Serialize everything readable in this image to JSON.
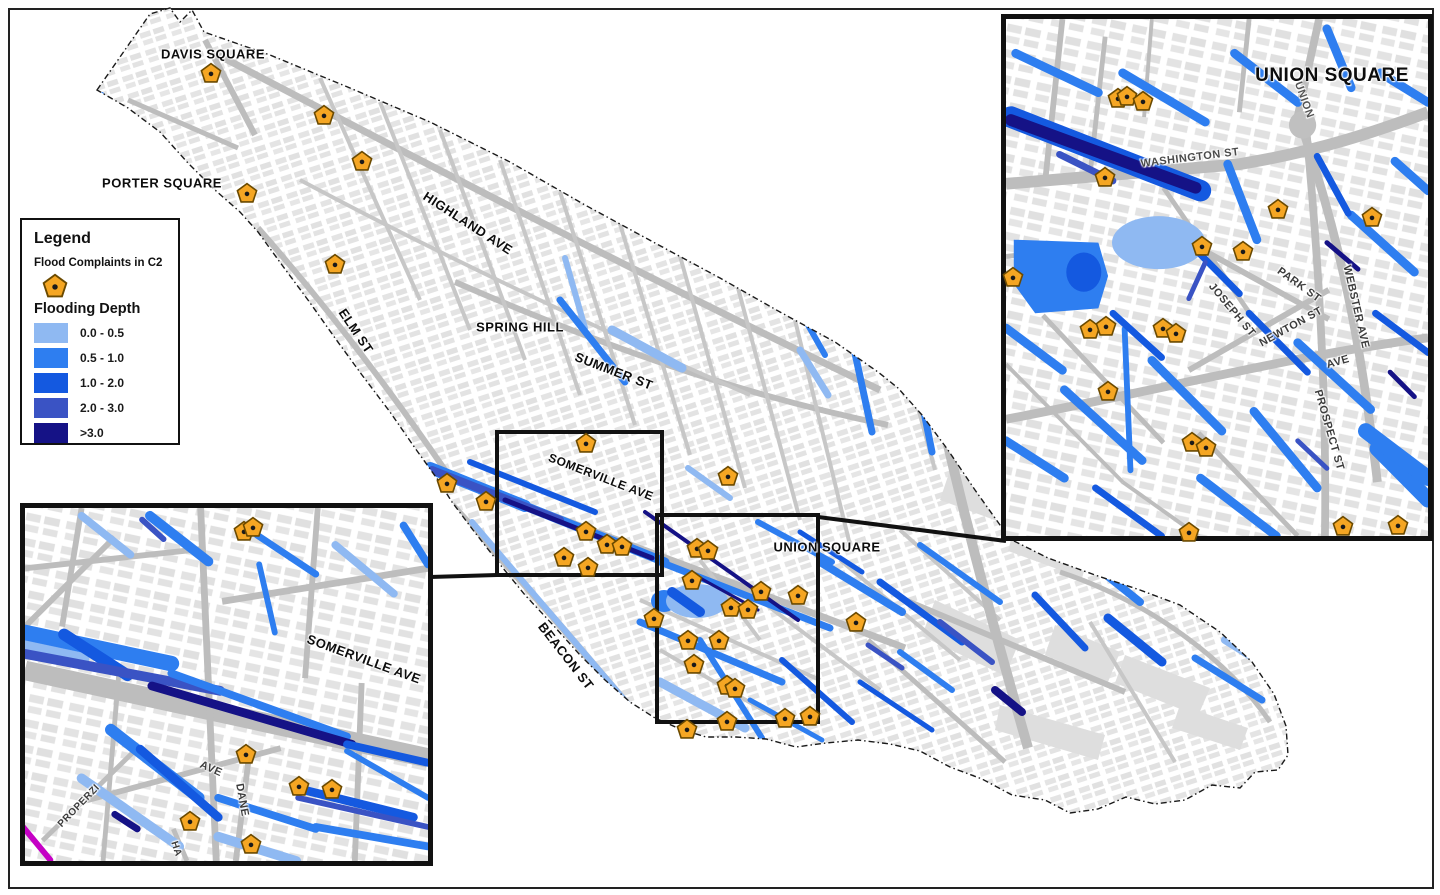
{
  "legend": {
    "title": "Legend",
    "complaints_label": "Flood Complaints in C2",
    "depth_title": "Flooding Depth",
    "marker_color": "#F5A623",
    "marker_outline": "#6B4A00",
    "classes": [
      {
        "label": "0.0 - 0.5",
        "color": "#8FB9F2"
      },
      {
        "label": "0.5 - 1.0",
        "color": "#2E7EF0"
      },
      {
        "label": "1.0 - 2.0",
        "color": "#1459E0"
      },
      {
        "label": "2.0 - 3.0",
        "color": "#3A53C4"
      },
      {
        "label": ">3.0",
        "color": "#151286"
      }
    ]
  },
  "main_map": {
    "labels": [
      {
        "text": "DAVIS SQUARE",
        "x": 213,
        "y": 54,
        "rot": 0,
        "size": 13
      },
      {
        "text": "PORTER SQUARE",
        "x": 162,
        "y": 183,
        "rot": 0,
        "size": 13
      },
      {
        "text": "HIGHLAND AVE",
        "x": 468,
        "y": 223,
        "rot": 33,
        "size": 13
      },
      {
        "text": "ELM ST",
        "x": 356,
        "y": 331,
        "rot": 56,
        "size": 13
      },
      {
        "text": "SPRING HILL",
        "x": 520,
        "y": 327,
        "rot": 0,
        "size": 13
      },
      {
        "text": "SUMMER ST",
        "x": 614,
        "y": 371,
        "rot": 21,
        "size": 13
      },
      {
        "text": "SOMERVILLE AVE",
        "x": 601,
        "y": 477,
        "rot": 21,
        "size": 12
      },
      {
        "text": "UNION SQUARE",
        "x": 827,
        "y": 547,
        "rot": 0,
        "size": 13
      },
      {
        "text": "BEACON ST",
        "x": 566,
        "y": 656,
        "rot": 52,
        "size": 13
      }
    ],
    "markers": [
      [
        211,
        74
      ],
      [
        324,
        116
      ],
      [
        362,
        162
      ],
      [
        247,
        194
      ],
      [
        335,
        265
      ],
      [
        447,
        484
      ],
      [
        486,
        502
      ],
      [
        586,
        444
      ],
      [
        728,
        477
      ],
      [
        586,
        532
      ],
      [
        607,
        545
      ],
      [
        622,
        547
      ],
      [
        564,
        558
      ],
      [
        588,
        568
      ],
      [
        697,
        549
      ],
      [
        708,
        551
      ],
      [
        692,
        581
      ],
      [
        761,
        592
      ],
      [
        798,
        596
      ],
      [
        731,
        608
      ],
      [
        748,
        610
      ],
      [
        654,
        619
      ],
      [
        688,
        641
      ],
      [
        719,
        641
      ],
      [
        694,
        665
      ],
      [
        727,
        686
      ],
      [
        735,
        689
      ],
      [
        856,
        623
      ],
      [
        687,
        730
      ],
      [
        727,
        722
      ],
      [
        785,
        719
      ],
      [
        810,
        717
      ]
    ]
  },
  "inset_top_right": {
    "labels": [
      {
        "text": "UNION SQUARE",
        "x": 1332,
        "y": 76,
        "rot": 0,
        "size": 19
      },
      {
        "text": "WASHINGTON ST",
        "x": 1190,
        "y": 158,
        "rot": -7,
        "size": 11,
        "color": "#4A4A4A"
      },
      {
        "text": "UNION",
        "x": 1304,
        "y": 100,
        "rot": 70,
        "size": 11,
        "color": "#555555"
      },
      {
        "text": "PARK ST",
        "x": 1299,
        "y": 285,
        "rot": 36,
        "size": 11,
        "color": "#3C3C3C"
      },
      {
        "text": "JOSEPH ST",
        "x": 1232,
        "y": 310,
        "rot": 50,
        "size": 11,
        "color": "#3C3C3C"
      },
      {
        "text": "NEWTON ST",
        "x": 1291,
        "y": 327,
        "rot": -29,
        "size": 11,
        "color": "#3C3C3C"
      },
      {
        "text": "WEBSTER AVE",
        "x": 1356,
        "y": 307,
        "rot": 77,
        "size": 11,
        "color": "#3C3C3C"
      },
      {
        "text": "AVE",
        "x": 1338,
        "y": 362,
        "rot": -16,
        "size": 11,
        "color": "#3C3C3C"
      },
      {
        "text": "PROSPECT ST",
        "x": 1329,
        "y": 430,
        "rot": 74,
        "size": 11,
        "color": "#3C3C3C"
      }
    ],
    "markers": [
      [
        1118,
        99
      ],
      [
        1127,
        97
      ],
      [
        1143,
        102
      ],
      [
        1105,
        178
      ],
      [
        1278,
        210
      ],
      [
        1372,
        218
      ],
      [
        1202,
        247
      ],
      [
        1243,
        252
      ],
      [
        1013,
        278
      ],
      [
        1090,
        330
      ],
      [
        1106,
        327
      ],
      [
        1163,
        329
      ],
      [
        1176,
        334
      ],
      [
        1108,
        392
      ],
      [
        1192,
        443
      ],
      [
        1206,
        448
      ],
      [
        1189,
        533
      ],
      [
        1343,
        527
      ],
      [
        1398,
        526
      ]
    ]
  },
  "inset_bottom_left": {
    "labels": [
      {
        "text": "SOMERVILLE AVE",
        "x": 364,
        "y": 659,
        "rot": 20,
        "size": 13
      },
      {
        "text": "AVE",
        "x": 211,
        "y": 769,
        "rot": 24,
        "size": 11,
        "color": "#3C3C3C"
      },
      {
        "text": "DANE",
        "x": 242,
        "y": 800,
        "rot": 80,
        "size": 11,
        "color": "#3C3C3C"
      },
      {
        "text": "PROPERZI",
        "x": 79,
        "y": 806,
        "rot": -46,
        "size": 10,
        "color": "#3C3C3C"
      },
      {
        "text": "HA",
        "x": 176,
        "y": 849,
        "rot": 72,
        "size": 10,
        "color": "#3C3C3C"
      }
    ],
    "markers": [
      [
        244,
        532
      ],
      [
        253,
        528
      ],
      [
        246,
        755
      ],
      [
        299,
        787
      ],
      [
        332,
        790
      ],
      [
        190,
        822
      ],
      [
        251,
        845
      ]
    ]
  }
}
